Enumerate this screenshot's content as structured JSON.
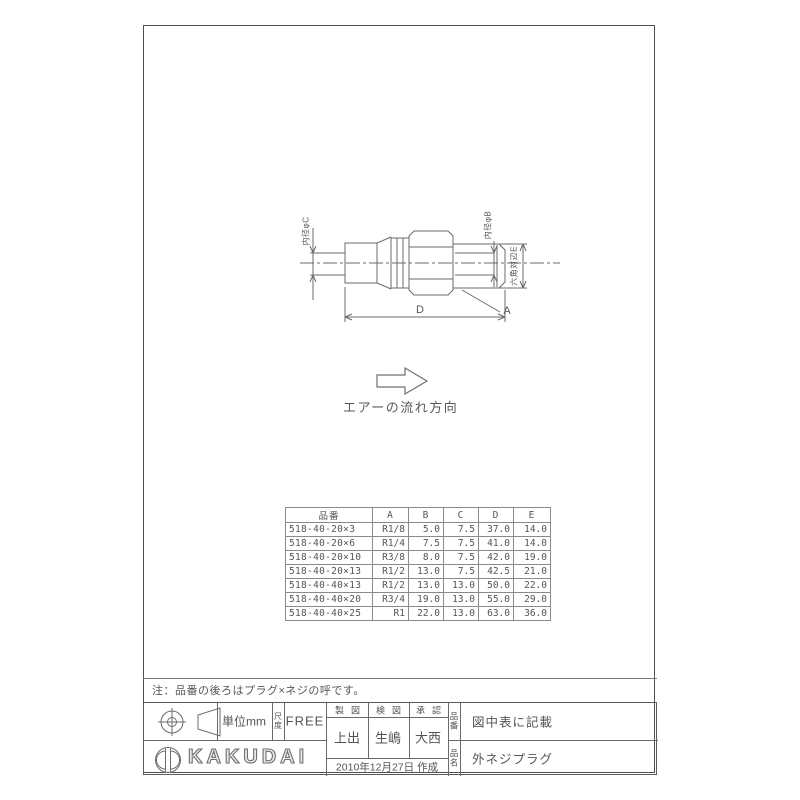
{
  "drawing": {
    "dim_label_inner_left": "内径φC",
    "dim_label_inner_right": "内径φB",
    "dim_label_hex": "六角対辺E",
    "dim_label_length": "D",
    "dim_label_thread": "A",
    "flow_label": "エアーの流れ方向"
  },
  "note": "注：品番の後ろはプラグ×ネジの呼です。",
  "spec_table": {
    "headers": [
      "品番",
      "A",
      "B",
      "C",
      "D",
      "E"
    ],
    "rows": [
      [
        "518-40-20×3",
        "R1/8",
        "5.0",
        "7.5",
        "37.0",
        "14.0"
      ],
      [
        "518-40-20×6",
        "R1/4",
        "7.5",
        "7.5",
        "41.0",
        "14.0"
      ],
      [
        "518-40-20×10",
        "R3/8",
        "8.0",
        "7.5",
        "42.0",
        "19.0"
      ],
      [
        "518-40-20×13",
        "R1/2",
        "13.0",
        "7.5",
        "42.5",
        "21.0"
      ],
      [
        "518-40-40×13",
        "R1/2",
        "13.0",
        "13.0",
        "50.0",
        "22.0"
      ],
      [
        "518-40-40×20",
        "R3/4",
        "19.0",
        "13.0",
        "55.0",
        "29.0"
      ],
      [
        "518-40-40×25",
        "R1",
        "22.0",
        "13.0",
        "63.0",
        "36.0"
      ]
    ]
  },
  "title_block": {
    "unit": "単位mm",
    "scale_label": "尺度",
    "scale_value": "FREE",
    "columns": [
      {
        "role": "製図",
        "name": "上出"
      },
      {
        "role": "検図",
        "name": "生嶋"
      },
      {
        "role": "承認",
        "name": "大西"
      }
    ],
    "date": "2010年12月27日 作成",
    "part_number_label": "品番",
    "part_number": "図中表に記載",
    "part_name_label": "品名",
    "part_name": "外ネジプラグ",
    "company": "KAKUDAI"
  }
}
